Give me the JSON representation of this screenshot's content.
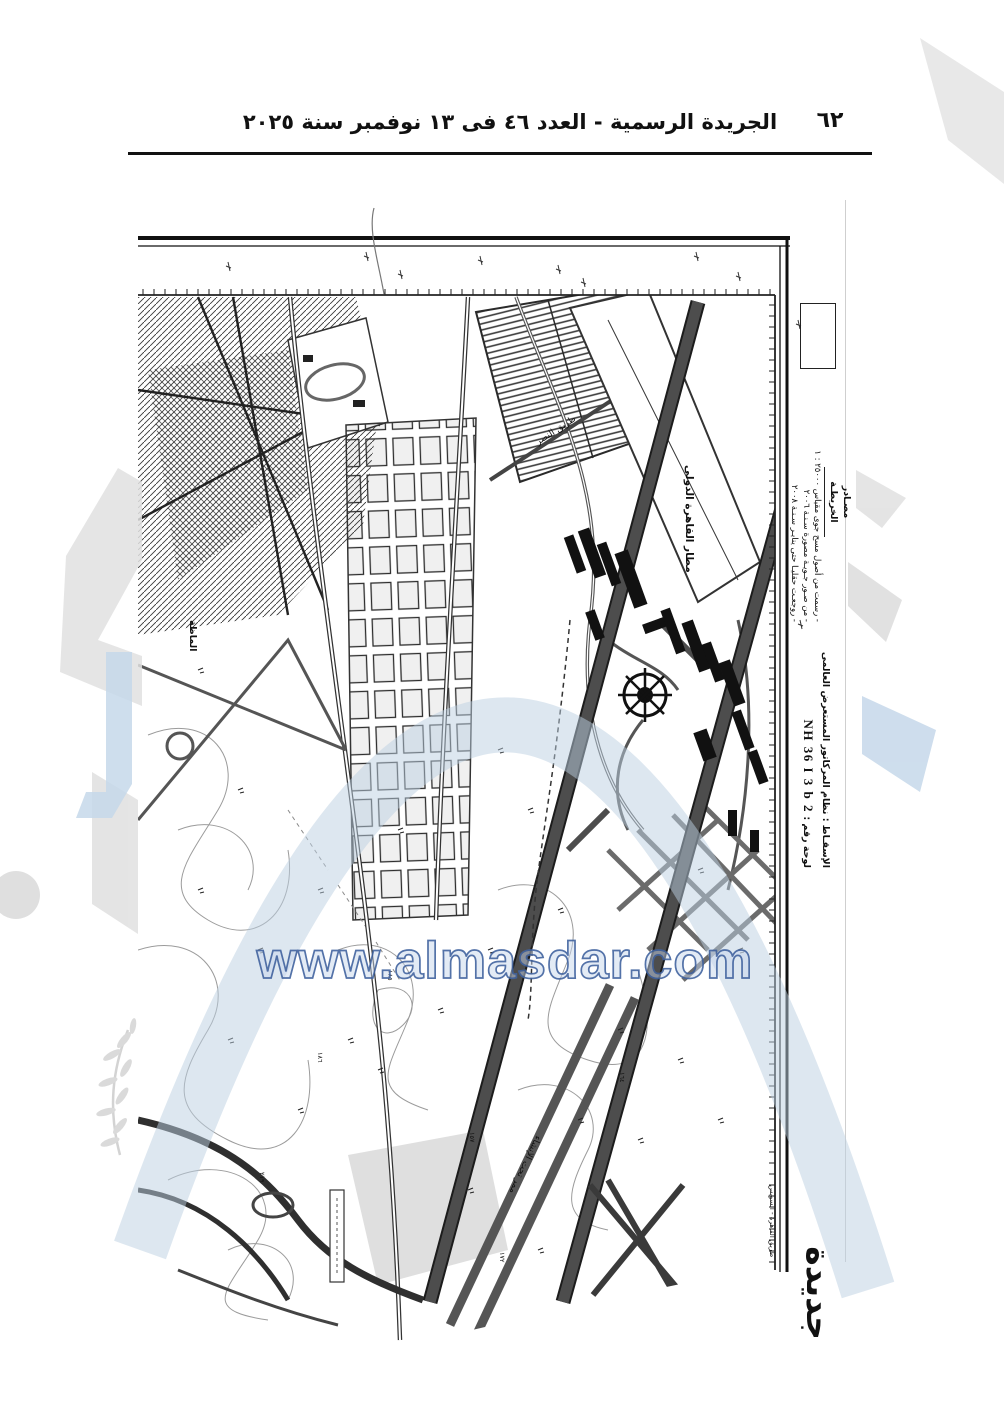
{
  "header": {
    "title": "الجريدة الرسمية - العدد ٤٦ فى ١٣ نوفمبر سنة ٢٠٢٥",
    "page_number": "٦٢"
  },
  "margin": {
    "sources_heading": "مصـادر الخريطـة",
    "source_1": "- رسمت من أصول مسح جوى مقياس ٢٥٠٠٠ : ١",
    "source_2": "- من صـور جـويـة مصورة سـنـة ٢٠٠٦",
    "source_3": "- روجعـت حقليـا حتى ينايـر سـنـة ٢٠٠٨",
    "projection": "الإسقـاط : نظام المركاتور المستعرض العالمى",
    "sheet_label": "لوحة رقم :",
    "sheet_number": "NH 36 I 3 b 2",
    "sheet_title_partial": "جديدة"
  },
  "labels": {
    "airport": "مطار القاهرة الدولى",
    "nasr_road": "طريق النصر",
    "runway_construction": "ممر تحت الإنشاء",
    "cairo_suez_road": "طريق القاهرة - السويس",
    "district": "الماظة",
    "elevations": [
      "١٨٥",
      "١٨٦",
      "١٥٧",
      "١٦٤",
      "٢١٩",
      "١٧٢"
    ]
  },
  "watermark": {
    "url": "www.almasdar.com",
    "stroke_blue": "#41639f",
    "fill_blue": "#ccdcec",
    "light_grey": "#e0e0e0"
  }
}
